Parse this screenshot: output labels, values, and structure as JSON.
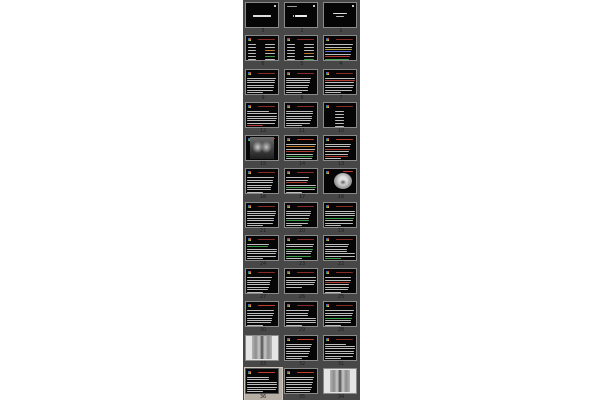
{
  "app": {
    "view": "slide-sorter-thumbnail-pane",
    "background_color": "#ffffff",
    "panel_color": "#474747",
    "title_dark_red": "#8a2a24",
    "title_bright_red": "#c23b2e",
    "body_text_color": "#bdbdbd",
    "accent_green": "#3f9e4a",
    "accent_orange": "#c07a2a",
    "accent_blue": "#5a6fd0",
    "accent_yellow": "#b8a23a",
    "accent_red": "#b03a30"
  },
  "panel": {
    "x": 243,
    "width": 117,
    "columns": 3,
    "rows": 12,
    "slide_order": "right-to-left",
    "selected_slide": 36,
    "slides": [
      {
        "n": 3,
        "kind": "title-c",
        "title": null
      },
      {
        "n": 2,
        "kind": "title-b",
        "title": null
      },
      {
        "n": 1,
        "kind": "title-a",
        "title": null
      },
      {
        "n": 6,
        "kind": "cols",
        "title": "#8a2a24",
        "accents": {
          "2": "#c07a2a",
          "4": "#3f9e4a"
        }
      },
      {
        "n": 5,
        "kind": "cols",
        "title": "#8a2a24",
        "accents": {
          "3": "#c07a2a",
          "5": "#3f9e4a"
        }
      },
      {
        "n": 4,
        "kind": "text",
        "title": "#8a2a24",
        "lines": 8,
        "accents": {
          "2": "#b8a23a",
          "3": "#5a6fd0",
          "5": "#b03a30",
          "6": "#3f9e4a"
        }
      },
      {
        "n": 9,
        "kind": "text",
        "title": "#8a2a24",
        "lines": 7,
        "accents": {}
      },
      {
        "n": 8,
        "kind": "text",
        "title": "#8a2a24",
        "lines": 7,
        "accents": {}
      },
      {
        "n": 7,
        "kind": "text",
        "title": "#8a2a24",
        "lines": 7,
        "accents": {
          "1": "#b03a30"
        }
      },
      {
        "n": 12,
        "kind": "text",
        "title": "#8a2a24",
        "lines": 7,
        "accents": {
          "6": "#b03a30"
        }
      },
      {
        "n": 11,
        "kind": "text",
        "title": "#8a2a24",
        "lines": 7,
        "accents": {}
      },
      {
        "n": 10,
        "kind": "clist",
        "title": "#8a2a24",
        "lines": 6,
        "accents": {}
      },
      {
        "n": 15,
        "kind": "chest",
        "title": "#c23b2e"
      },
      {
        "n": 14,
        "kind": "text",
        "title": "#c23b2e",
        "lines": 8,
        "accents": {
          "1": "#c07a2a",
          "3": "#b03a30",
          "5": "#3f9e4a"
        }
      },
      {
        "n": 13,
        "kind": "text",
        "title": "#c23b2e",
        "lines": 7,
        "accents": {
          "2": "#b03a30",
          "5": "#b03a30"
        }
      },
      {
        "n": 18,
        "kind": "text",
        "title": "#8a2a24",
        "lines": 7,
        "accents": {}
      },
      {
        "n": 17,
        "kind": "text",
        "title": "#8a2a24",
        "lines": 7,
        "accents": {
          "2": "#b03a30",
          "4": "#3f9e4a"
        }
      },
      {
        "n": 16,
        "kind": "ct",
        "title": "#c23b2e"
      },
      {
        "n": 21,
        "kind": "text",
        "title": "#8a2a24",
        "lines": 7,
        "accents": {}
      },
      {
        "n": 20,
        "kind": "text",
        "title": "#8a2a24",
        "lines": 7,
        "accents": {
          "4": "#3f9e4a"
        }
      },
      {
        "n": 19,
        "kind": "text",
        "title": "#8a2a24",
        "lines": 7,
        "accents": {
          "3": "#3f9e4a"
        }
      },
      {
        "n": 24,
        "kind": "text",
        "title": "#8a2a24",
        "lines": 7,
        "accents": {
          "1": "#3f9e4a"
        }
      },
      {
        "n": 23,
        "kind": "text",
        "title": "#8a2a24",
        "lines": 7,
        "accents": {
          "2": "#3f9e4a",
          "5": "#3f9e4a"
        }
      },
      {
        "n": 22,
        "kind": "text",
        "title": "#8a2a24",
        "lines": 7,
        "accents": {
          "6": "#3f9e4a"
        }
      },
      {
        "n": 27,
        "kind": "text",
        "title": "#8a2a24",
        "lines": 7,
        "accents": {}
      },
      {
        "n": 26,
        "kind": "text",
        "title": "#8a2a24",
        "lines": 5,
        "accents": {}
      },
      {
        "n": 25,
        "kind": "text",
        "title": "#8a2a24",
        "lines": 7,
        "accents": {
          "2": "#b03a30"
        }
      },
      {
        "n": 30,
        "kind": "text",
        "title": "#c23b2e",
        "lines": 7,
        "accents": {}
      },
      {
        "n": 29,
        "kind": "text",
        "title": "#8a2a24",
        "lines": 7,
        "accents": {}
      },
      {
        "n": 28,
        "kind": "text",
        "title": "#8a2a24",
        "lines": 7,
        "accents": {
          "3": "#3f9e4a"
        }
      },
      {
        "n": 33,
        "kind": "spine",
        "title": null
      },
      {
        "n": 32,
        "kind": "text",
        "title": "#c23b2e",
        "lines": 7,
        "accents": {}
      },
      {
        "n": 31,
        "kind": "text",
        "title": "#8a2a24",
        "lines": 7,
        "accents": {}
      },
      {
        "n": 36,
        "kind": "text",
        "title": "#c23b2e",
        "lines": 7,
        "accents": {},
        "selected": true
      },
      {
        "n": 35,
        "kind": "text",
        "title": "#c23b2e",
        "lines": 8,
        "accents": {}
      },
      {
        "n": 34,
        "kind": "spine",
        "title": null
      }
    ]
  }
}
